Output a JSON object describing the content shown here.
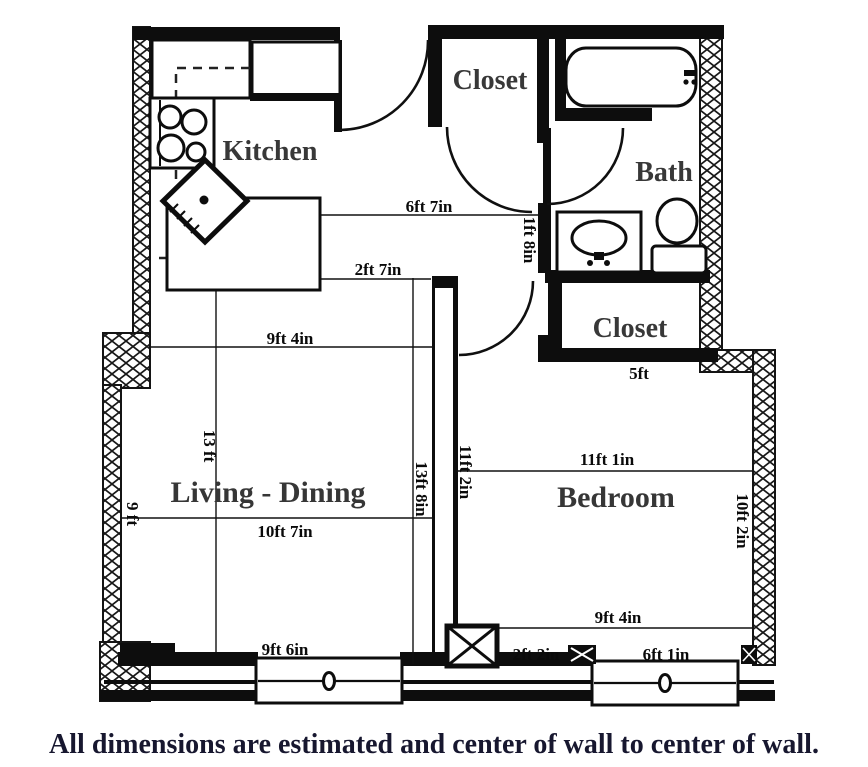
{
  "rooms": {
    "kitchen": "Kitchen",
    "closet_top": "Closet",
    "bath": "Bath",
    "closet_bedroom": "Closet",
    "living_dining": "Living - Dining",
    "bedroom": "Bedroom"
  },
  "dimensions": {
    "hall_to_bath": "6ft 7in",
    "island_to_partition": "2ft 7in",
    "sink_wall": "1ft 8in",
    "living_top_width": "9ft 4in",
    "living_length": "13 ft",
    "left_wall_section": "9 ft",
    "living_width": "10ft 7in",
    "partition_wall_length": "13ft 8in",
    "bedroom_depth": "11ft 2in",
    "bedroom_width": "11ft 1in",
    "bedroom_closet_width": "5ft",
    "right_wall_section": "10ft 2in",
    "living_window_width": "9ft 6in",
    "bedroom_bottom_width": "9ft 4in",
    "bottom_wall_segment": "2ft 2in",
    "bedroom_window_width": "6ft 1in"
  },
  "caption": "All dimensions are estimated and center of wall to center of wall.",
  "colors": {
    "wall": "#0d0d0d",
    "room_label": "#383838",
    "dimension_label": "#0a0a0a",
    "caption": "#17172f",
    "background": "#ffffff"
  }
}
